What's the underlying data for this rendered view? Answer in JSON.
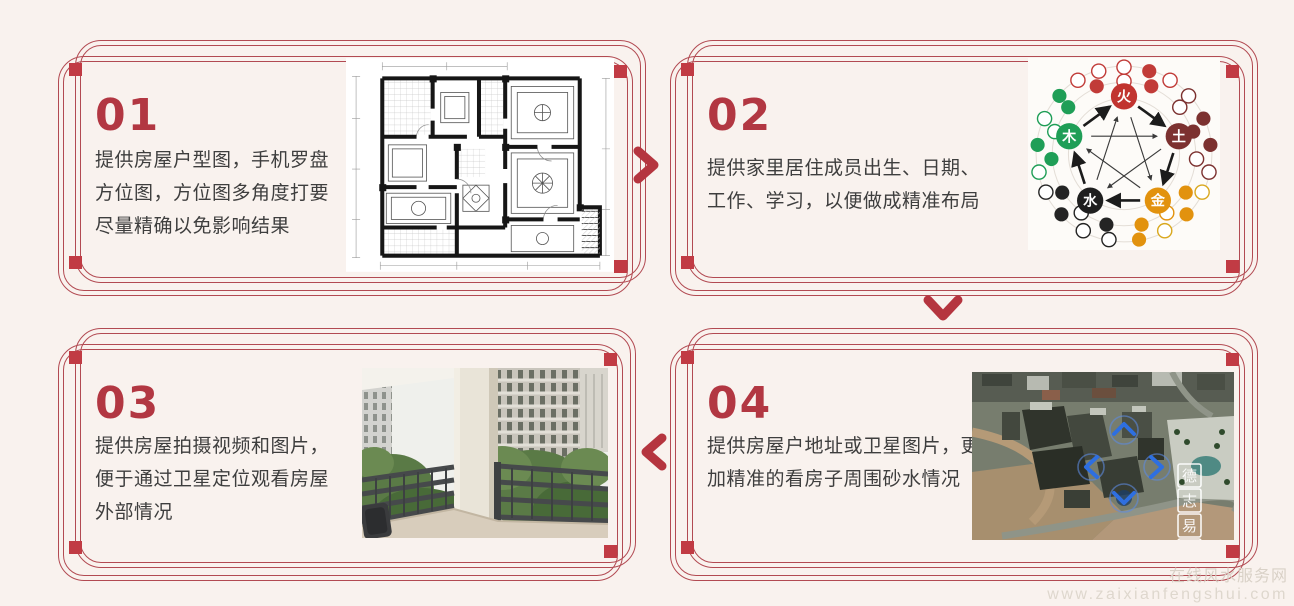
{
  "page": {
    "background_color": "#f9f2ee",
    "accent_color": "#b23742",
    "frame_color": "#b24a52"
  },
  "cards": [
    {
      "number": "01",
      "lines": [
        "提供房屋户型图，手机罗盘",
        "方位图，方位图多角度打要",
        "尽量精确以免影响结果"
      ],
      "image": "apartment-floor-plan"
    },
    {
      "number": "02",
      "lines": [
        "提供家里居住成员出生、日期、",
        "工作、学习，以便做成精准布局"
      ],
      "image": "five-elements-diagram"
    },
    {
      "number": "03",
      "lines": [
        "提供房屋拍摄视频和图片，",
        "便于通过卫星定位观看房屋",
        "外部情况"
      ],
      "image": "balcony-photo"
    },
    {
      "number": "04",
      "lines": [
        "提供房屋户地址或卫星图片，更",
        "加精准的看房子周围砂水情况"
      ],
      "image": "satellite-photo"
    }
  ],
  "five_elements": {
    "fire": "火",
    "earth": "土",
    "metal": "金",
    "water": "水",
    "wood": "木"
  },
  "satellite_watermark_chars": [
    "德",
    "志",
    "易"
  ],
  "footer_watermark": {
    "site_name": "在线风水服务网",
    "site_url": "www.zaixianfengshui.com"
  },
  "icons": {
    "step1_to_step2": "chevron-right",
    "step2_to_step4": "chevron-down",
    "step4_to_step3": "chevron-left"
  }
}
